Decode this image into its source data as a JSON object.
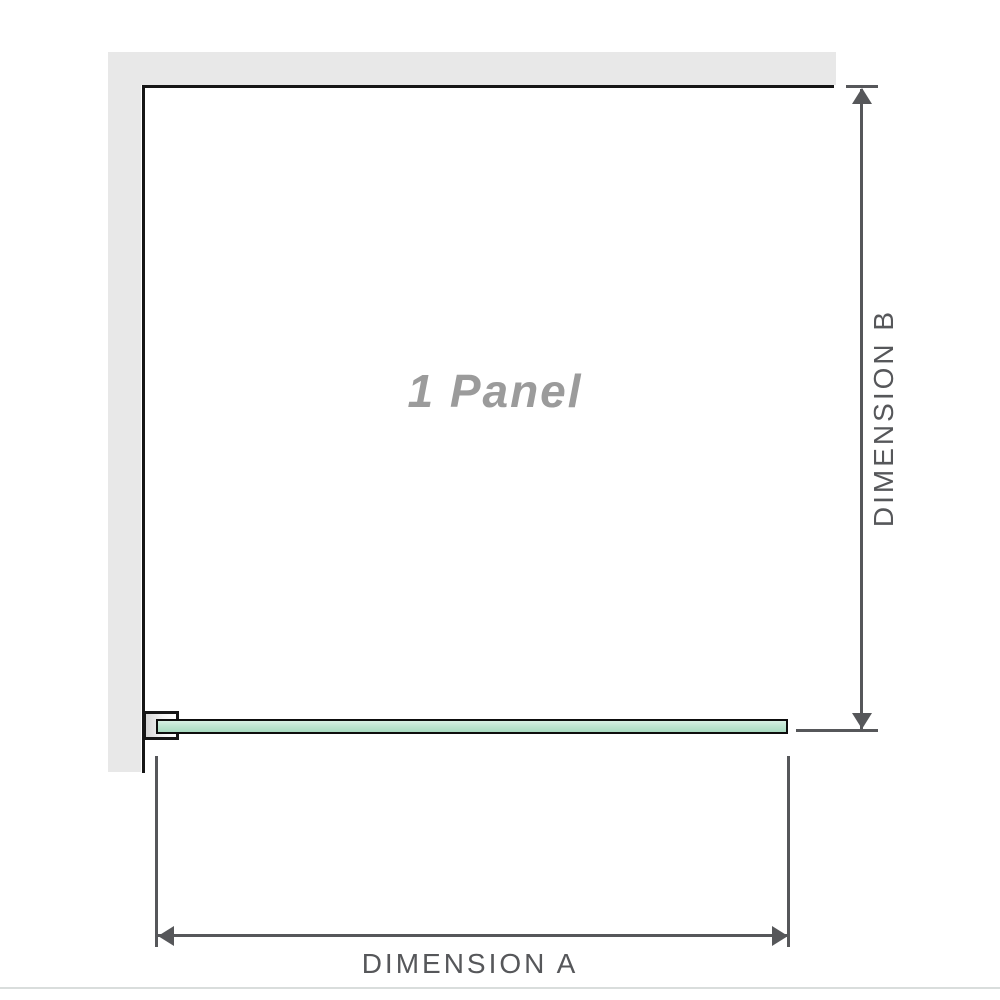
{
  "diagram": {
    "panel_label": "1 Panel",
    "dimension_a_label": "DIMENSION A",
    "dimension_b_label": "DIMENSION B"
  },
  "colors": {
    "background": "#ffffff",
    "wall": "#e8e8e8",
    "outline": "#161616",
    "dimension": "#56575a",
    "panel_label": "#9b9b9b",
    "glass_light": "#d8efe3",
    "glass_mid": "#bfe5d1",
    "glass_dark": "#a9dbc1",
    "glass_border": "#0d0d0d",
    "divider": "#d9dddc"
  }
}
